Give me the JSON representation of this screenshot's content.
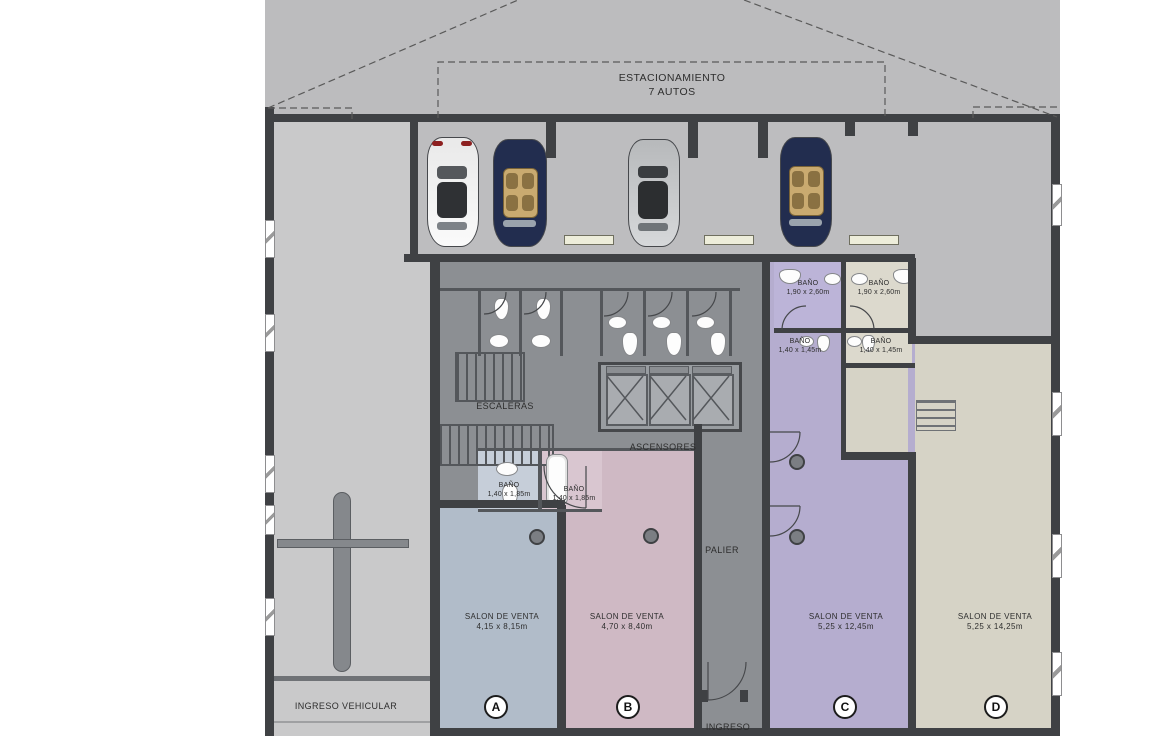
{
  "parking": {
    "line1": "ESTACIONAMIENTO",
    "line2": "7 AUTOS",
    "cars": [
      "white-car",
      "navy-convertible",
      "silver-car",
      "navy-convertible"
    ]
  },
  "core": {
    "stairs": "ESCALERAS",
    "elevators": "ASCENSORES",
    "hall": "PALIER",
    "entrance": "INGRESO"
  },
  "driveway": {
    "label": "INGRESO VEHICULAR"
  },
  "bathrooms": {
    "c_large": {
      "name": "BAÑO",
      "size": "1,90 x 2,60m"
    },
    "d_large": {
      "name": "BAÑO",
      "size": "1,90 x 2,60m"
    },
    "c_small": {
      "name": "BAÑO",
      "size": "1,40 x 1,45m"
    },
    "d_small": {
      "name": "BAÑO",
      "size": "1,40 x 1,45m"
    },
    "a_bath": {
      "name": "BAÑO",
      "size": "1,40 x 1,85m"
    },
    "b_bath": {
      "name": "BAÑO",
      "size": "1,40 x 1,85m"
    }
  },
  "units": [
    {
      "id": "A",
      "label": "SALON DE VENTA",
      "size": "4,15 x 8,15m"
    },
    {
      "id": "B",
      "label": "SALON DE VENTA",
      "size": "4,70 x 8,40m"
    },
    {
      "id": "C",
      "label": "SALON DE VENTA",
      "size": "5,25 x 12,45m"
    },
    {
      "id": "D",
      "label": "SALON DE VENTA",
      "size": "5,25 x 14,25m"
    }
  ],
  "colors": {
    "unit_a": "#b1bcc9",
    "unit_b": "#cfb9c4",
    "unit_c": "#b5adcf",
    "unit_d": "#d6d3c6",
    "core": "#8c8f93",
    "parking": "#bdbdbf",
    "driveway": "#c9c9ca",
    "wall": "#3f4144",
    "wheel_stop": "#ededda",
    "car_white": "#f2f2f2",
    "car_navy": "#222d4f",
    "car_silver": "#c6c8ca"
  }
}
